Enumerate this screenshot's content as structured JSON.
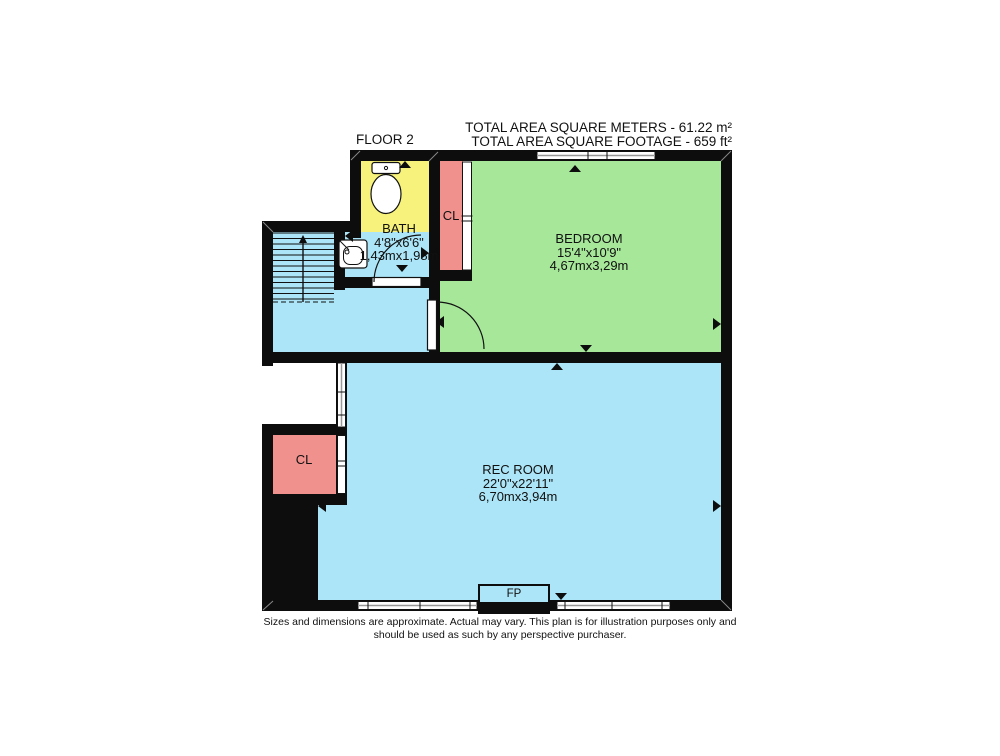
{
  "header": {
    "floor_label": "FLOOR 2",
    "total_area_meters": "TOTAL AREA SQUARE METERS - 61.22 m²",
    "total_area_footage": "TOTAL AREA SQUARE FOOTAGE - 659 ft²"
  },
  "rooms": {
    "bath": {
      "name": "BATH",
      "dims_imperial": "4'8\"x6'6\"",
      "dims_metric": "1,43mx1,98m"
    },
    "bedroom": {
      "name": "BEDROOM",
      "dims_imperial": "15'4\"x10'9\"",
      "dims_metric": "4,67mx3,29m"
    },
    "rec_room": {
      "name": "REC ROOM",
      "dims_imperial": "22'0\"x22'11\"",
      "dims_metric": "6,70mx3,94m"
    },
    "closet_top": {
      "label": "CL"
    },
    "closet_bottom": {
      "label": "CL"
    }
  },
  "fireplace": {
    "label": "FP"
  },
  "footer": {
    "line1": "Sizes and dimensions are approximate. Actual may vary. This plan is for illustration purposes only and",
    "line2": "should be used as such by any perspective purchaser."
  },
  "colors": {
    "wall": "#0d0d0d",
    "bath": "#f6f27c",
    "closet": "#f0918e",
    "bedroom": "#a6e79a",
    "hall": "#ace5f7"
  }
}
